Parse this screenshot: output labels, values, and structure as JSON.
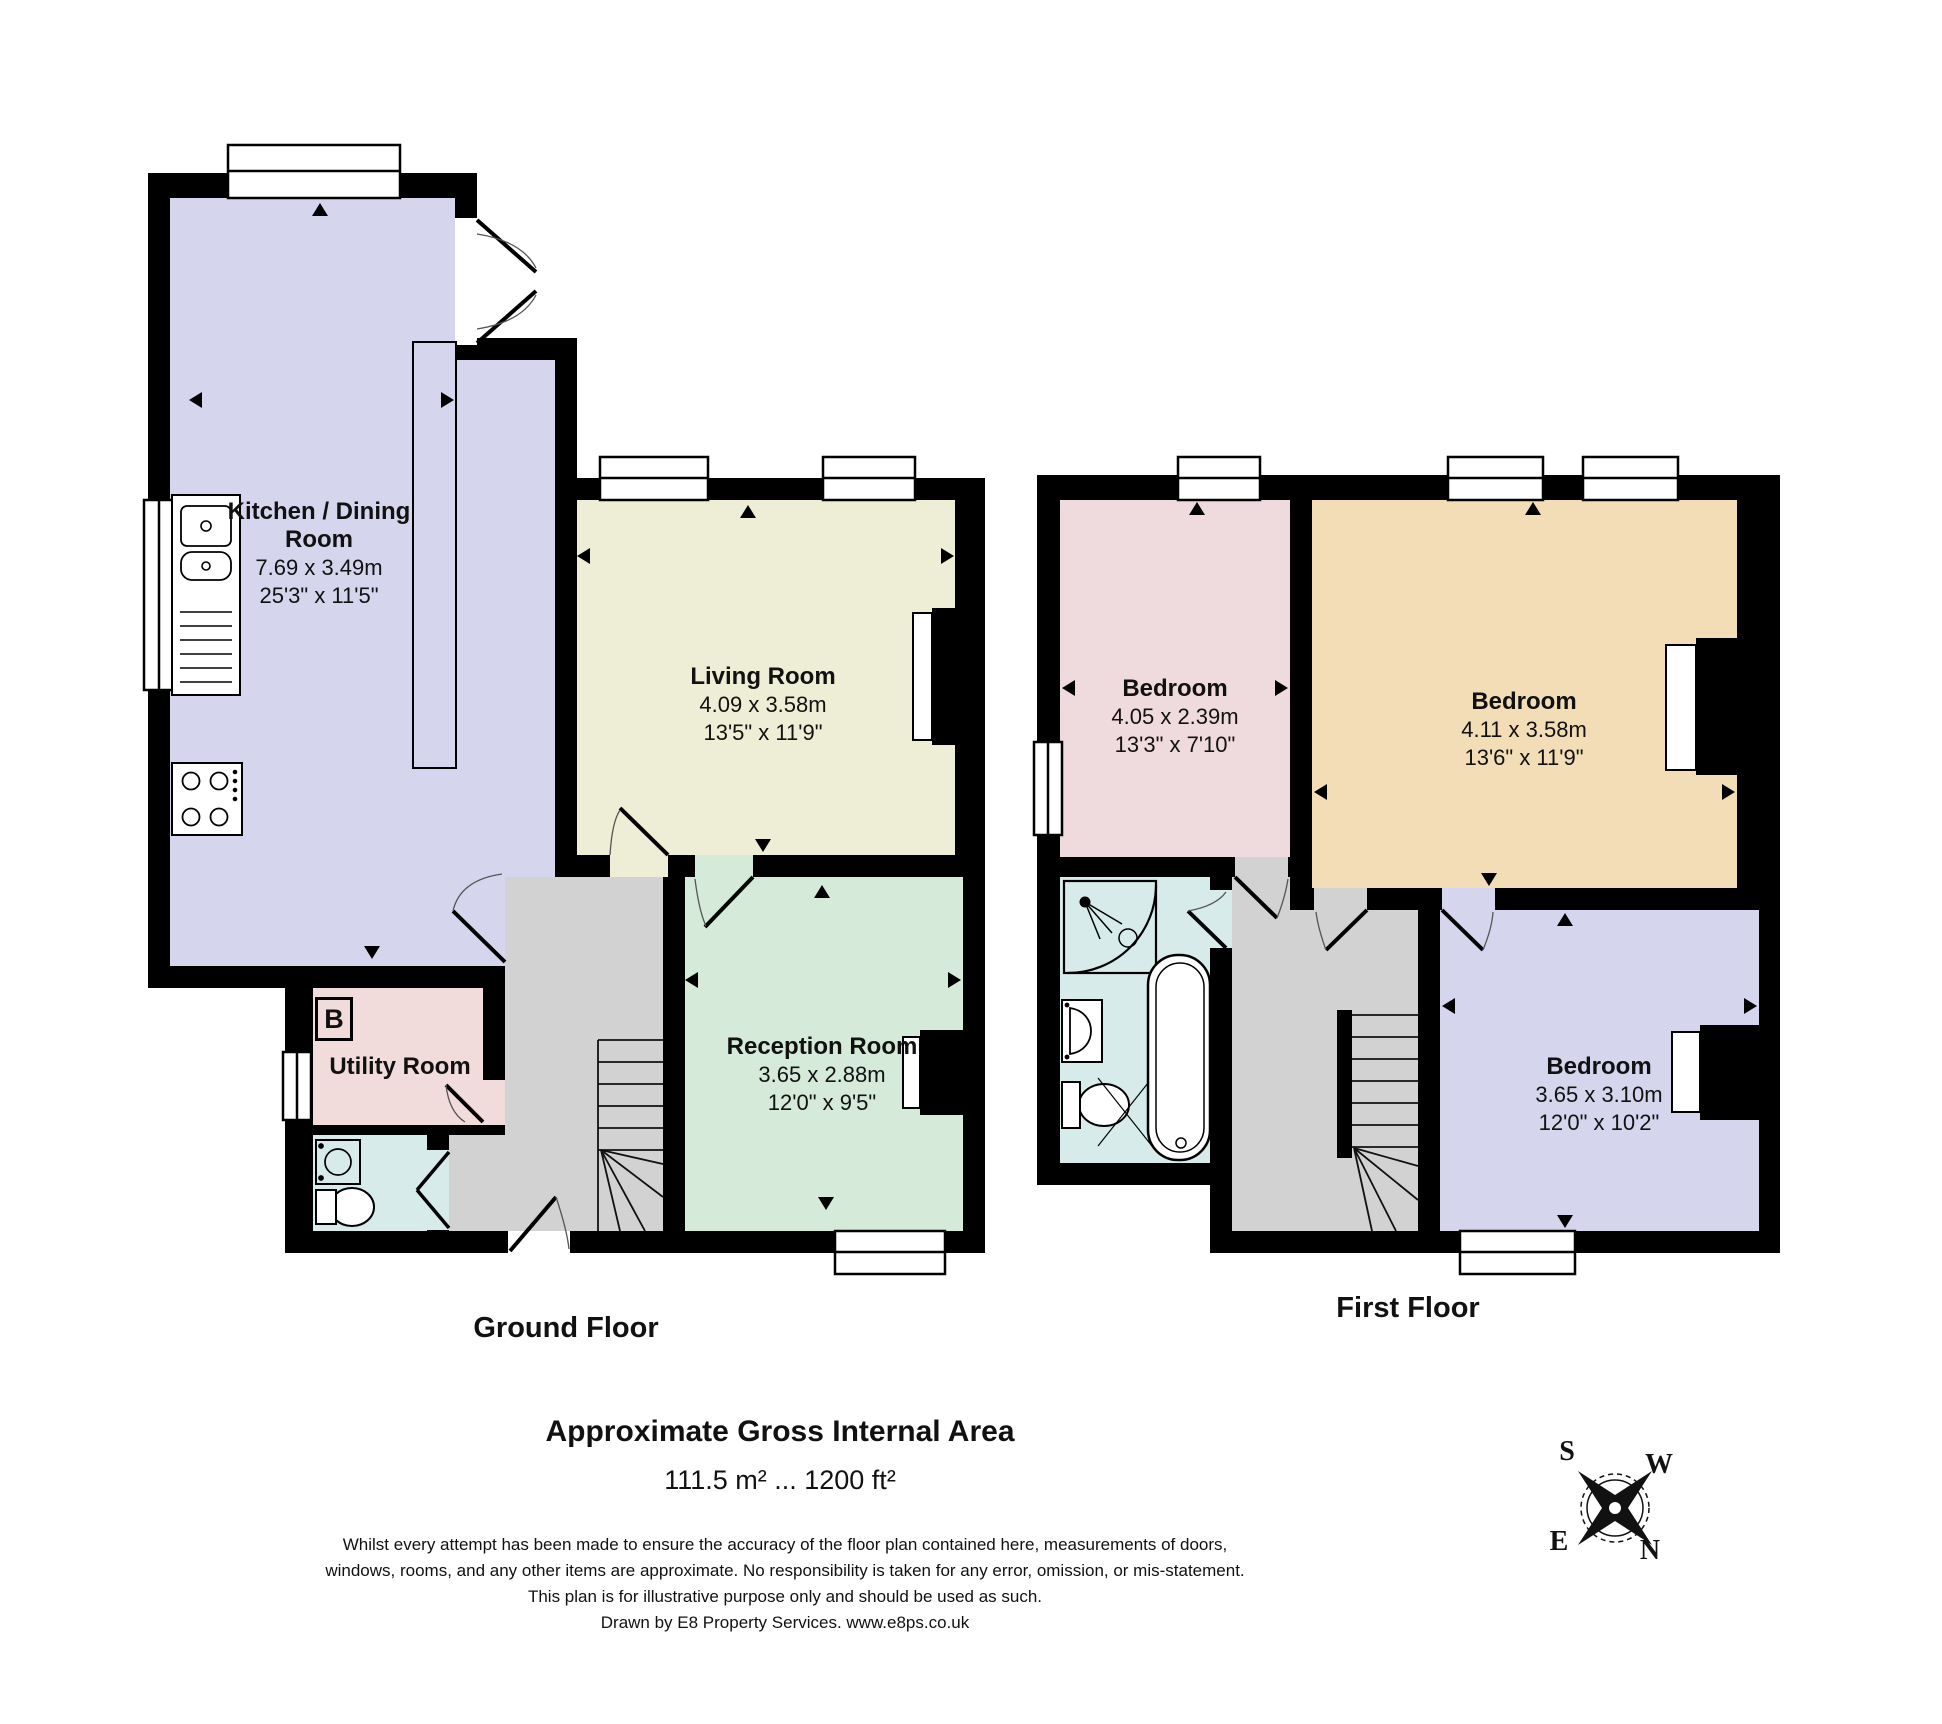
{
  "page": {
    "area_heading": "Approximate Gross Internal Area",
    "area_value": "111.5 m² ... 1200 ft²"
  },
  "ground_floor": {
    "label": "Ground Floor",
    "kitchen": {
      "name": "Kitchen / Dining Room",
      "metric": "7.69 x 3.49m",
      "imperial": "25'3\" x 11'5\"",
      "color": "#d6d5ee"
    },
    "living": {
      "name": "Living Room",
      "metric": "4.09 x 3.58m",
      "imperial": "13'5\" x 11'9\"",
      "color": "#eeeed6"
    },
    "reception": {
      "name": "Reception Room",
      "metric": "3.65 x 2.88m",
      "imperial": "12'0\" x 9'5\"",
      "color": "#d5ead8"
    },
    "utility": {
      "name": "Utility Room",
      "color": "#f2dcdb"
    },
    "boiler_label": "B",
    "wc_color": "#d7ebea",
    "hall_color": "#d2d2d2"
  },
  "first_floor": {
    "label": "First Floor",
    "bedroom1": {
      "name": "Bedroom",
      "metric": "4.05 x 2.39m",
      "imperial": "13'3\" x 7'10\"",
      "color": "#efdade"
    },
    "bedroom2": {
      "name": "Bedroom",
      "metric": "4.11 x 3.58m",
      "imperial": "13'6\" x 11'9\"",
      "color": "#f3ddb6"
    },
    "bedroom3": {
      "name": "Bedroom",
      "metric": "3.65 x 3.10m",
      "imperial": "12'0\" x 10'2\"",
      "color": "#d6d5ee"
    },
    "bathroom_color": "#d7ebea",
    "landing_color": "#d2d2d2"
  },
  "disclaimer": {
    "line1": "Whilst every attempt has been made to ensure the accuracy of the floor plan contained here, measurements of doors,",
    "line2": "windows, rooms, and any other items are approximate. No responsibility is taken for any error, omission, or mis-statement.",
    "line3": "This plan is for illustrative purpose only and should be used as such.",
    "line4": "Drawn by E8 Property Services. www.e8ps.co.uk"
  },
  "compass": {
    "north": "N",
    "south": "S",
    "east": "E",
    "west": "W"
  },
  "wall_color": "#000000"
}
